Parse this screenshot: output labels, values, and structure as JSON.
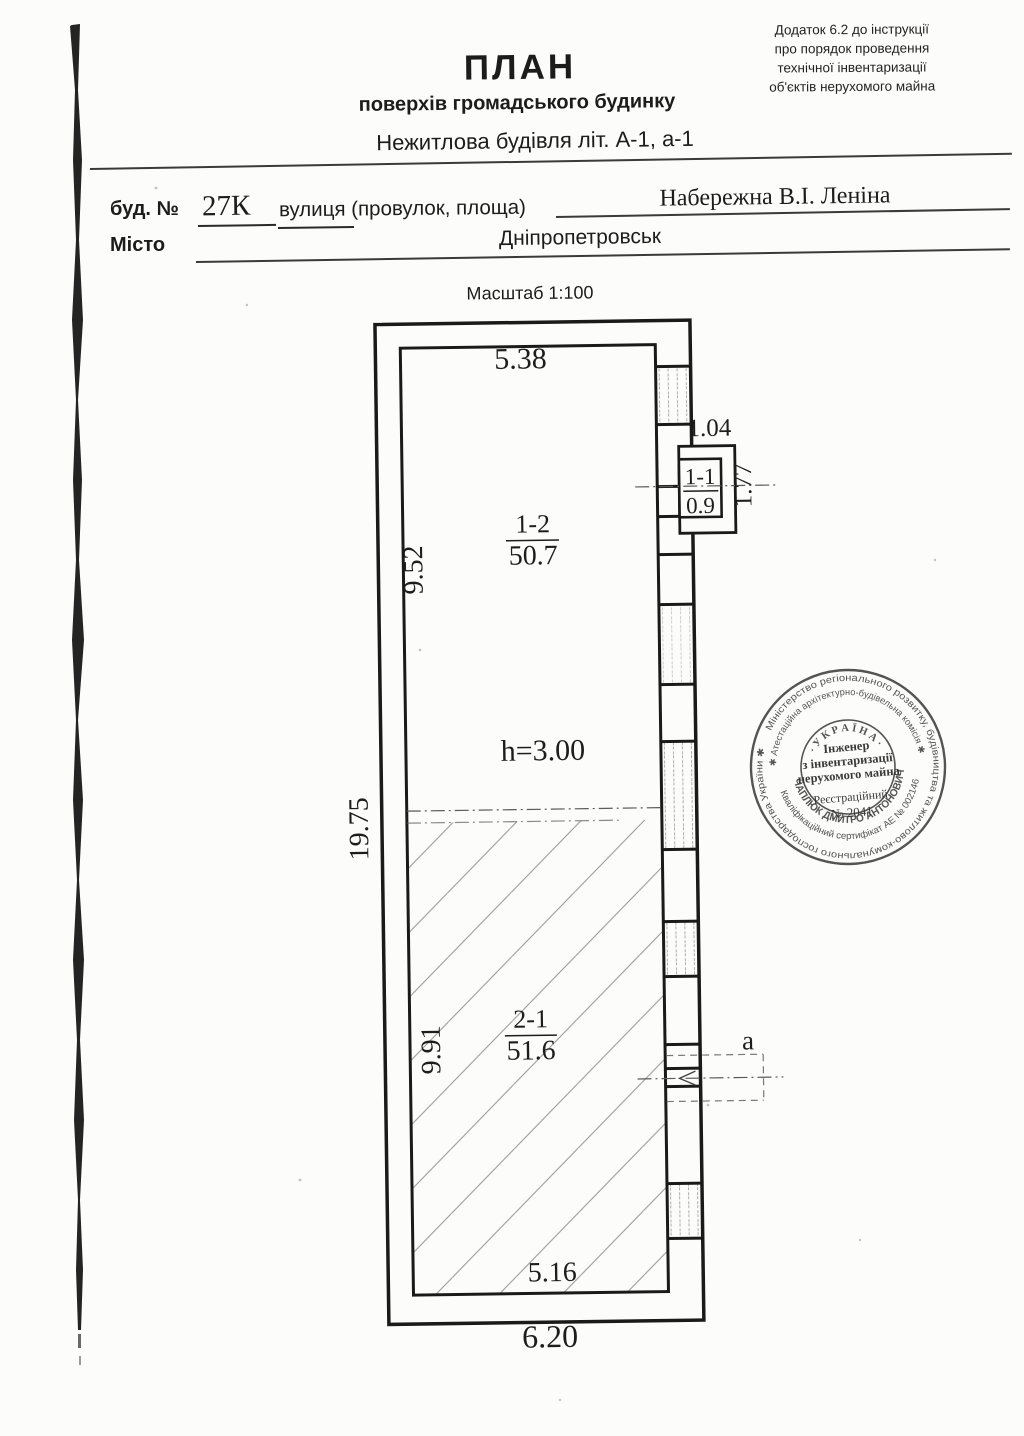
{
  "document": {
    "appendix_note": [
      "Додаток 6.2 до інструкції",
      "про порядок проведення",
      "технічної інвентаризації",
      "об'єктів нерухомого майна"
    ],
    "title": "ПЛАН",
    "subtitle": "поверхів громадського будинку",
    "building_type_line": "Нежитлова будівля літ. А-1, а-1",
    "fields": {
      "house_label": "буд. №",
      "house_number": "27К",
      "street_label": "вулиця (провулок, площа)",
      "street_value": "Набережна В.І. Леніна",
      "city_label": "Місто",
      "city_value": "Дніпропетровськ",
      "scale": "Масштаб 1:100"
    }
  },
  "plan": {
    "dimensions": {
      "top_width": "5.38",
      "room1_depth": "9.52",
      "overall_height": "19.75",
      "room2_depth": "9.91",
      "bottom_inner_width": "5.16",
      "bottom_outer_width": "6.20",
      "annex_width": "1.04",
      "annex_depth": "1.77",
      "ceiling_height": "h=3.00"
    },
    "rooms": [
      {
        "id": "1-2",
        "area": "50.7"
      },
      {
        "id": "2-1",
        "area": "51.6"
      },
      {
        "id": "1-1",
        "area": "0.9"
      }
    ],
    "door_label": "а"
  },
  "stamp": {
    "outer_ring": "Міністерство регіонального розвитку, будівництва та житлово-комунального господарства України ✱",
    "commission_ring": "✱ Атестаційна архітектурно-будівельна комісія ✱",
    "certificate_ring": "Кваліфікаційний сертифікат АЕ № 002146",
    "name_ring": "ЧАПЛЮК ДМИТРО АНТОНОВИЧ",
    "country_arc": "· У К Р А Ї Н А ·",
    "center_title_1": "Інженер",
    "center_title_2": "з інвентаризації",
    "center_title_3": "нерухомого майна",
    "registration_label": "Реєстраційний",
    "registration_number": "№ 2041"
  }
}
